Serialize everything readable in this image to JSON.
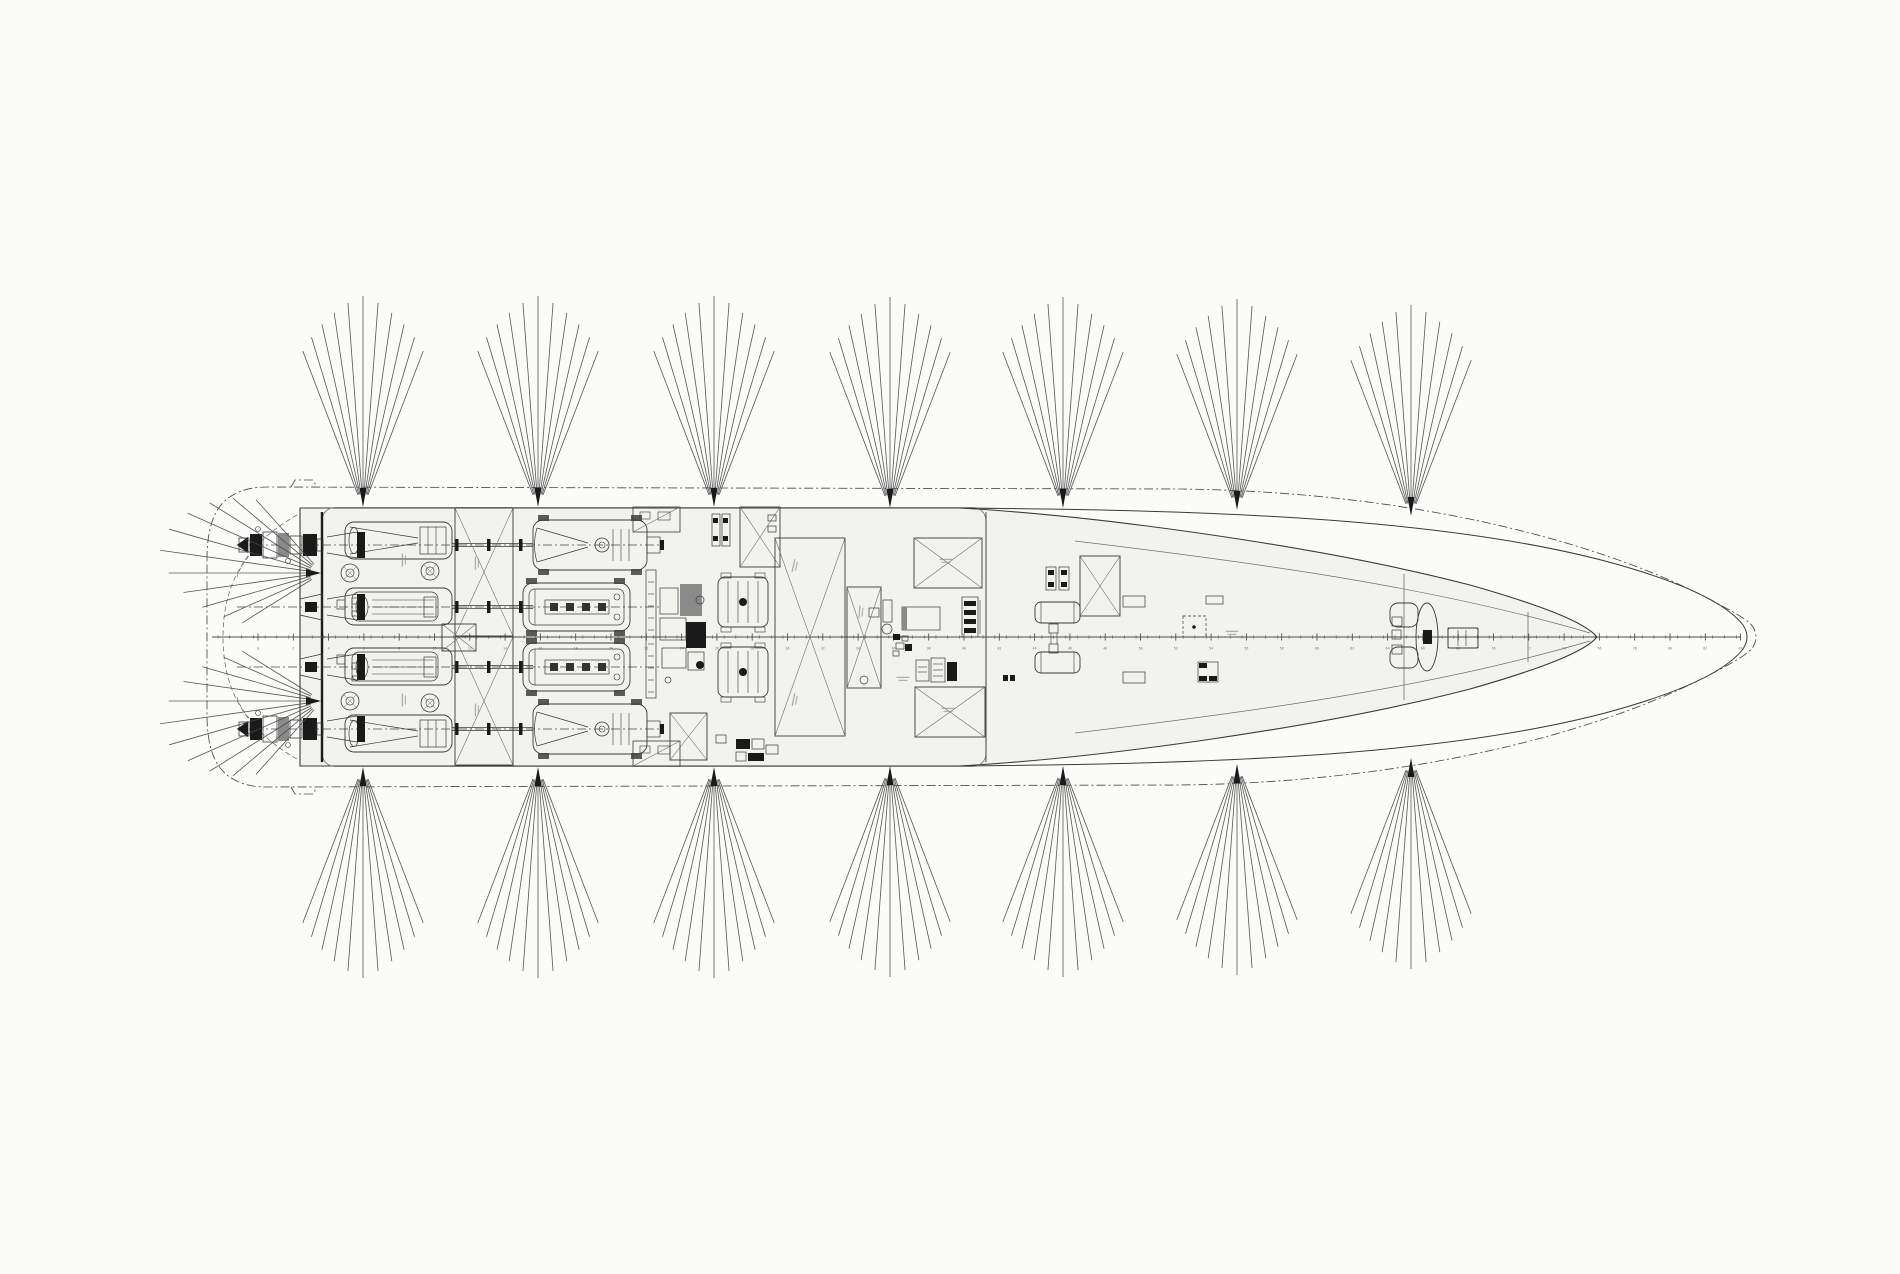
{
  "canvas": {
    "w": 1900,
    "h": 1274,
    "bg": "#fbfbf9"
  },
  "palette": {
    "line": "#3a3a3a",
    "thin": "#6e6e6e",
    "dark": "#1a1a1a",
    "gray": "#8a8a8a",
    "deck": "#f2f2ee",
    "dash": "#4a4a4a",
    "smudge": "#979797",
    "fan": "#4a4a4a",
    "ruler": "#4c4c4c",
    "label": "#7a7a7a",
    "pad": "#3f3f3f"
  },
  "ship": {
    "cl_y": 637,
    "deck_fill": "M300,508 L960,508 C1100,516 1320,546 1470,585 C1540,605 1585,622 1597,637 C1585,652 1540,669 1470,689 C1320,728 1100,758 960,766 L300,766 Z",
    "sheer": "M955,508 C1180,510 1430,515 1605,561 C1683,582 1726,603 1743,625 Q1751,637 1743,649 C1726,671 1683,692 1605,713 C1430,759 1180,764 955,766",
    "bulwark": "M207,560 C207,530 213,506 233,495 C245,488 257,487 269,487 L1180,489 C1435,492 1625,551 1724,607 C1739,615 1749,621 1753,627 Q1759,637 1753,647 C1749,653 1739,659 1724,667 C1625,723 1435,782 1180,785 L269,787 C257,787 245,786 233,779 C213,768 207,744 207,714 Z",
    "notch_top": "M291,487 L295,480 L313,480 L317,487",
    "notch_bot": "M291,787 L295,794 L313,794 L317,787",
    "inner_top": "M1075,541 C1250,562 1430,586 1590,633",
    "inner_bot": "M1075,733 C1250,712 1430,688 1590,641",
    "stern_arc": "M297,515 C237,549 223,594 223,637 C223,680 237,725 297,759",
    "stern_arc2": "M262,540 C247,558 240,566 237,577 M237,697 C240,708 247,716 262,734",
    "casing": [
      322,
      507.5,
      664,
      259,
      13
    ],
    "transom": [
      322,
      512,
      762
    ],
    "house_x": [
      986,
      512,
      762
    ],
    "bulkheads": [
      [
        1404,
        574,
        700
      ],
      [
        1528,
        612,
        662
      ]
    ]
  },
  "ruler": {
    "x0": 212,
    "x1": 1741,
    "y": 637,
    "minor_step": 11.77,
    "minor_h": 1.8,
    "major0": 258,
    "major_step": 35.3,
    "major_h": 3.6,
    "label_y": 646.5,
    "label0": 0,
    "label_step": 2,
    "font": 3.4
  },
  "rows": {
    "list": [
      {
        "cy": 545,
        "style": "outer"
      },
      {
        "cy": 607,
        "style": "inner"
      },
      {
        "cy": 667,
        "style": "inner"
      },
      {
        "cy": 729,
        "style": "outer"
      }
    ],
    "line_x": [
      237,
      662
    ],
    "duct": {
      "x": 345,
      "w": 107,
      "h": 37
    },
    "shaft": {
      "x1": 452,
      "x2": 533,
      "flanges": [
        455,
        487,
        519
      ]
    },
    "engine_outer": {
      "x": 533,
      "w": 114,
      "h": 50
    },
    "engine_inner": {
      "x": 523,
      "w": 107,
      "h": 48
    },
    "jet_x": 237,
    "jet_rects": [
      [
        2,
        -7,
        10,
        14,
        0
      ],
      [
        13,
        -11,
        12,
        22,
        1
      ],
      [
        26,
        -13,
        14,
        26,
        0
      ],
      [
        41,
        -12,
        11,
        24,
        2
      ],
      [
        53,
        -9,
        12,
        18,
        0
      ],
      [
        66,
        -11,
        14,
        22,
        1
      ],
      [
        80,
        -6,
        6,
        12,
        0
      ]
    ],
    "jet_circles": [
      [
        21,
        -16,
        2.5
      ],
      [
        51,
        16,
        2.5
      ]
    ]
  },
  "fans": {
    "lines": 11,
    "spread": 42,
    "r0": 14,
    "len_max": 212,
    "len_min": 168,
    "top": [
      [
        363,
        508
      ],
      [
        538,
        508
      ],
      [
        714,
        508
      ],
      [
        890,
        509
      ],
      [
        1063,
        509
      ],
      [
        1237,
        511
      ],
      [
        1411,
        517
      ]
    ],
    "bottom": [
      [
        363,
        766
      ],
      [
        538,
        766
      ],
      [
        714,
        766
      ],
      [
        890,
        765
      ],
      [
        1063,
        765
      ],
      [
        1237,
        763
      ],
      [
        1411,
        757
      ]
    ],
    "stern": [
      {
        "apex": [
          322,
          573
        ],
        "from": 132,
        "to": 212,
        "peak": 170
      },
      {
        "apex": [
          322,
          701
        ],
        "from": 148,
        "to": 228,
        "peak": 190
      }
    ],
    "stern_len_max": 165,
    "stern_len_min": 94,
    "stern_r0": 12
  },
  "xboxes": [
    [
      455,
      508,
      58,
      128
    ],
    [
      455,
      637,
      58,
      128
    ],
    [
      442,
      624,
      34,
      27
    ],
    [
      740,
      507,
      40,
      60
    ],
    [
      670,
      713,
      37,
      47
    ],
    [
      775,
      538,
      70,
      198
    ],
    [
      847,
      587,
      34,
      101
    ],
    [
      914,
      538,
      68,
      50
    ],
    [
      915,
      687,
      70,
      50
    ],
    [
      1080,
      556,
      40,
      60
    ]
  ],
  "equipment": {
    "vent_panels": [
      [
        633,
        507
      ],
      [
        633,
        741
      ]
    ],
    "gensets": [
      [
        718,
        577
      ],
      [
        718,
        647
      ]
    ],
    "liferafts": [
      [
        1035,
        602,
        45,
        21
      ],
      [
        1035,
        652,
        45,
        21
      ]
    ],
    "windlass": {
      "bracket_top": [
        1390,
        603,
        28,
        24
      ],
      "bracket_bot": [
        1390,
        647,
        28,
        21
      ],
      "cols": [
        [
          1392,
          617,
          10,
          9
        ],
        [
          1392,
          630,
          9,
          9
        ],
        [
          1392,
          645,
          10,
          9
        ]
      ],
      "drum": [
        1427,
        637,
        11,
        34
      ],
      "hub": [
        1423,
        630,
        9,
        14
      ],
      "motor": [
        1448,
        628,
        30,
        20
      ]
    },
    "dash_squares": [
      [
        1183,
        616,
        23,
        21
      ]
    ],
    "smudges": [
      [
        477,
        563,
        -90
      ],
      [
        477,
        710,
        -90
      ],
      [
        404,
        560,
        -90
      ],
      [
        404,
        700,
        -90
      ],
      [
        795,
        566,
        -78
      ],
      [
        795,
        700,
        -78
      ],
      [
        861,
        612,
        -85
      ],
      [
        946,
        561,
        0
      ],
      [
        948,
        710,
        0
      ],
      [
        1232,
        633,
        0
      ],
      [
        903,
        679,
        0
      ]
    ]
  },
  "details": {
    "polys": [
      [
        [
          300,
          599
        ],
        [
          322,
          594
        ],
        [
          322,
          620
        ],
        [
          300,
          615
        ]
      ],
      [
        [
          300,
          659
        ],
        [
          322,
          654
        ],
        [
          322,
          680
        ],
        [
          300,
          675
        ]
      ]
    ],
    "rects": [
      [
        305,
        602,
        12,
        10,
        1
      ],
      [
        305,
        662,
        12,
        10,
        1
      ],
      [
        337,
        600,
        8,
        9,
        0
      ],
      [
        352,
        598,
        6,
        6,
        0
      ],
      [
        337,
        655,
        8,
        9,
        0
      ],
      [
        352,
        663,
        6,
        6,
        0
      ],
      [
        352,
        611,
        6,
        5,
        0
      ],
      [
        352,
        676,
        6,
        5,
        0
      ],
      [
        883,
        600,
        9,
        22,
        0
      ],
      [
        869,
        608,
        10,
        9,
        0
      ],
      [
        893,
        634,
        7,
        6,
        1
      ],
      [
        902,
        636,
        6,
        5,
        0
      ],
      [
        896,
        643,
        8,
        6,
        0
      ],
      [
        905,
        644,
        7,
        7,
        1
      ],
      [
        893,
        651,
        6,
        5,
        0
      ],
      [
        916,
        660,
        13,
        21,
        0
      ],
      [
        931,
        658,
        14,
        24,
        0
      ],
      [
        947,
        662,
        10,
        19,
        1
      ],
      [
        1003,
        675,
        5,
        6,
        1
      ],
      [
        1010,
        675,
        5,
        6,
        1
      ],
      [
        736,
        739,
        14,
        10,
        1
      ],
      [
        752,
        739,
        12,
        10,
        0
      ],
      [
        736,
        752,
        10,
        9,
        0
      ],
      [
        748,
        753,
        16,
        8,
        1
      ],
      [
        766,
        745,
        12,
        9,
        0
      ],
      [
        716,
        735,
        10,
        8,
        0
      ],
      [
        768,
        515,
        8,
        6,
        0
      ],
      [
        768,
        526,
        8,
        6,
        0
      ],
      [
        1049,
        624,
        9,
        9,
        0
      ],
      [
        1049,
        644,
        9,
        9,
        0
      ],
      [
        1123,
        596,
        22,
        11,
        0
      ],
      [
        1206,
        596,
        17,
        8,
        0
      ],
      [
        1123,
        672,
        22,
        11,
        0
      ],
      [
        646,
        570,
        10,
        128,
        0
      ],
      [
        660,
        588,
        18,
        26,
        0
      ],
      [
        680,
        584,
        22,
        32,
        2
      ],
      [
        660,
        618,
        26,
        22,
        0
      ],
      [
        686,
        622,
        20,
        26,
        1
      ],
      [
        662,
        648,
        24,
        20,
        0
      ],
      [
        688,
        652,
        16,
        18,
        0
      ],
      [
        962,
        597,
        16,
        40,
        0
      ],
      [
        964,
        601,
        12,
        5,
        1
      ],
      [
        964,
        610,
        12,
        5,
        1
      ],
      [
        964,
        619,
        12,
        5,
        1
      ],
      [
        964,
        628,
        12,
        5,
        1
      ],
      [
        902,
        607,
        38,
        23,
        0
      ],
      [
        902,
        607,
        5,
        23,
        2
      ],
      [
        1198,
        662,
        20,
        20,
        0
      ],
      [
        1199,
        663,
        8,
        5,
        1
      ],
      [
        1209,
        676,
        8,
        5,
        1
      ],
      [
        1199,
        676,
        8,
        5,
        1
      ],
      [
        712,
        514,
        8,
        32,
        0
      ],
      [
        722,
        514,
        8,
        32,
        0
      ],
      [
        713,
        518,
        5,
        5,
        1
      ],
      [
        723,
        518,
        5,
        5,
        1
      ],
      [
        713,
        536,
        5,
        5,
        1
      ],
      [
        723,
        536,
        5,
        5,
        1
      ],
      [
        1046,
        567,
        10,
        23,
        0
      ],
      [
        1059,
        567,
        10,
        23,
        0
      ],
      [
        1048,
        570,
        6,
        5,
        1
      ],
      [
        1061,
        570,
        6,
        5,
        1
      ],
      [
        1048,
        582,
        6,
        5,
        1
      ],
      [
        1061,
        582,
        6,
        5,
        1
      ],
      [
        1448,
        628,
        30,
        20,
        0
      ]
    ],
    "circles": [
      [
        887,
        629,
        5,
        0
      ],
      [
        864,
        680,
        4,
        0
      ],
      [
        700,
        600,
        4,
        0
      ],
      [
        700,
        665,
        4,
        1
      ],
      [
        668,
        680,
        3,
        0
      ],
      [
        1194,
        627,
        1.8,
        1
      ]
    ],
    "lines": [
      [
        847,
        637,
        881,
        637
      ],
      [
        918,
        667,
        927,
        667
      ],
      [
        918,
        672,
        927,
        672
      ],
      [
        933,
        664,
        943,
        664
      ],
      [
        933,
        670,
        943,
        670
      ],
      [
        933,
        676,
        943,
        676
      ],
      [
        1051,
        633,
        1051,
        644
      ],
      [
        1057,
        633,
        1057,
        644
      ],
      [
        1438,
        637,
        1448,
        637
      ],
      [
        648,
        582,
        654,
        582
      ],
      [
        648,
        594,
        654,
        594
      ],
      [
        648,
        606,
        654,
        606
      ],
      [
        648,
        618,
        654,
        618
      ],
      [
        648,
        630,
        654,
        630
      ],
      [
        648,
        644,
        654,
        644
      ],
      [
        648,
        656,
        654,
        656
      ],
      [
        648,
        668,
        654,
        668
      ],
      [
        648,
        680,
        654,
        680
      ],
      [
        648,
        692,
        654,
        692
      ],
      [
        980,
        600,
        980,
        634
      ],
      [
        1041,
        602,
        1041,
        623
      ],
      [
        1074,
        602,
        1074,
        623
      ],
      [
        1041,
        652,
        1041,
        673
      ],
      [
        1074,
        652,
        1074,
        673
      ],
      [
        1458,
        630,
        1458,
        646
      ],
      [
        1466,
        630,
        1466,
        646
      ]
    ]
  }
}
